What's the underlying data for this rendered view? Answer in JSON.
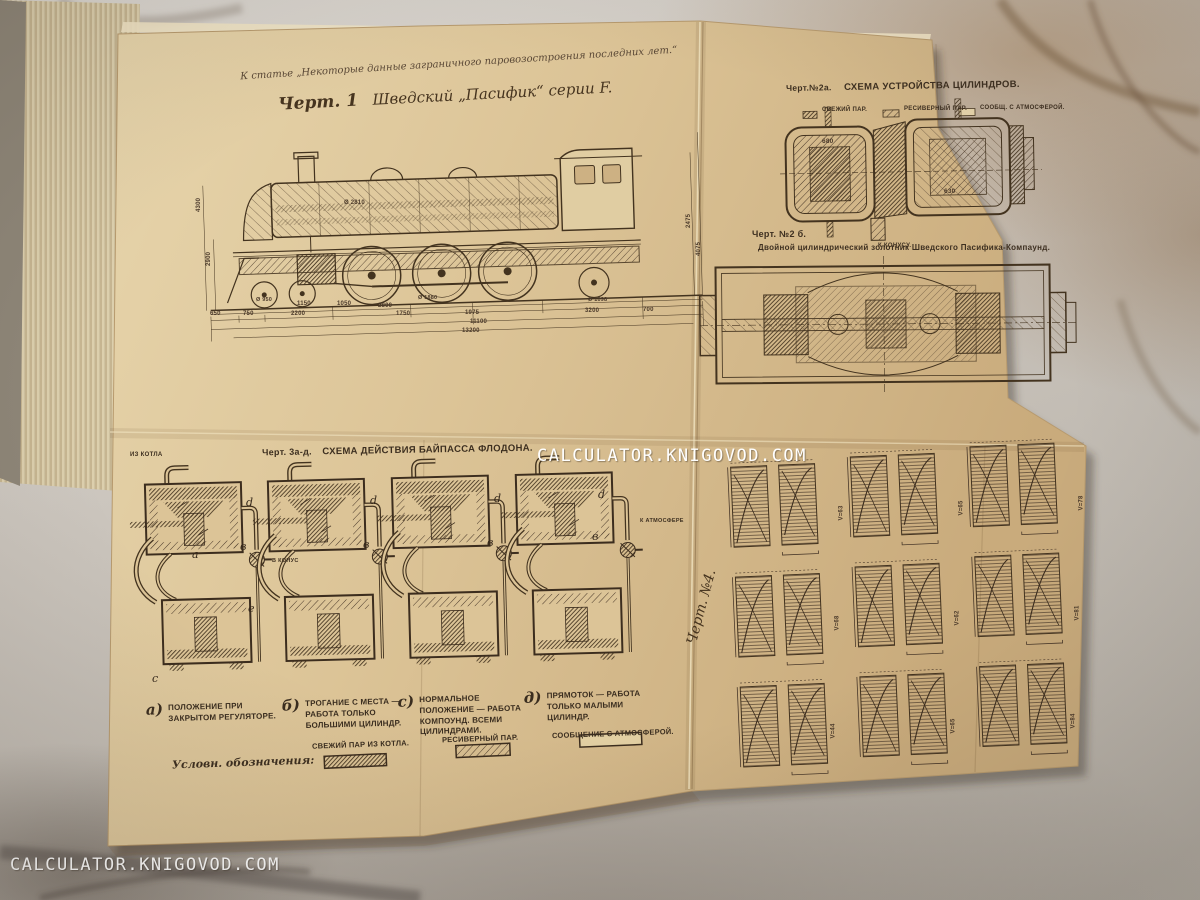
{
  "watermark": {
    "text": "CALCULATOR.KNIGOVOD.COM"
  },
  "plate": {
    "header_note": "К статье „Некоторые данные заграничного паровозостроения последних лет.“",
    "fig1": {
      "caption_prefix": "Черт. 1",
      "caption": "Шведский „Пасифик“ серии F.",
      "dims": [
        "1150",
        "1050",
        "2800",
        "650",
        "750",
        "2200",
        "1750",
        "1975",
        "3200",
        "700",
        "11100",
        "13200",
        "Ø 950",
        "Ø 1880",
        "Ø 1098",
        "4300",
        "2900",
        "2475",
        "4075",
        "Ø 2810"
      ]
    },
    "fig2a": {
      "caption_prefix": "Черт.№2а.",
      "caption": "СХЕМА УСТРОЙСТВА ЦИЛИНДРОВ.",
      "legend": [
        {
          "label": "СВЕЖИЙ ПАР.",
          "swatch": "dense-hatch"
        },
        {
          "label": "РЕСИВЕРНЫЙ ПАР.",
          "swatch": "diagonal-hatch"
        },
        {
          "label": "СООБЩ. С АТМОСФЕРОЙ.",
          "swatch": "empty"
        }
      ],
      "dims": [
        "680",
        "630"
      ],
      "outlet_label": "К КОНУСУ."
    },
    "fig2b": {
      "caption_prefix": "Черт. №2 б.",
      "caption": "Двойной цилиндрический золотник Шведского Пасифика-Компаунд."
    },
    "fig3": {
      "caption_prefix": "Черт. 3а-д.",
      "caption": "СХЕМА ДЕЙСТВИЯ БАЙПАССА ФЛОДОНА.",
      "inlet_label": "ИЗ КОТЛА",
      "cone_label": "В КОНУС",
      "atmosphere_label": "К АТМОСФЕРЕ",
      "part_letters": {
        "d": "d",
        "b": "в",
        "a": "а",
        "e": "е",
        "c": "с"
      },
      "captions": [
        {
          "letter": "а)",
          "text": "ПОЛОЖЕНИЕ ПРИ ЗАКРЫТОМ РЕГУЛЯТОРЕ."
        },
        {
          "letter": "б)",
          "text": "ТРОГАНИЕ С МЕСТА — РАБОТА ТОЛЬКО БОЛЬШИМИ ЦИЛИНДР."
        },
        {
          "letter": "с)",
          "text": "НОРМАЛЬНОЕ ПОЛОЖЕНИЕ — РАБОТА КОМПОУНД. ВСЕМИ ЦИЛИНДРАМИ."
        },
        {
          "letter": "д)",
          "text": "ПРЯМОТОК — РАБОТА ТОЛЬКО МАЛЫМИ ЦИЛИНДР."
        }
      ],
      "legend_title": "Условн. обозначения:",
      "legend": [
        {
          "label": "СВЕЖИЙ ПАР ИЗ КОТЛА.",
          "swatch": "dense-hatch"
        },
        {
          "label": "РЕСИВЕРНЫЙ ПАР.",
          "swatch": "diagonal-hatch"
        },
        {
          "label": "СООБЩЕНИЕ С АТМОСФЕРОЙ.",
          "swatch": "empty"
        }
      ]
    },
    "fig4": {
      "caption": "Черт. №4.",
      "annotations": [
        "V=63",
        "V=65",
        "V=78",
        "V=68",
        "V=62",
        "V=81",
        "V=44",
        "V=65",
        "V=84"
      ]
    }
  }
}
